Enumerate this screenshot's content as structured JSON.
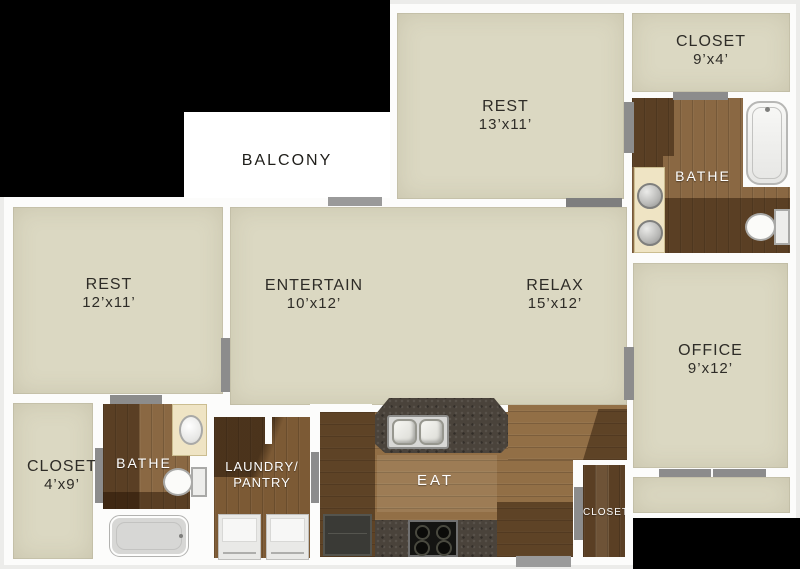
{
  "rooms": {
    "balcony": {
      "label": "BALCONY"
    },
    "rest_top": {
      "label": "REST",
      "dims": "13’x11’"
    },
    "closet_top_right": {
      "label": "CLOSET",
      "dims": "9’x4’"
    },
    "bathe_top": {
      "label": "BATHE"
    },
    "office": {
      "label": "OFFICE",
      "dims": "9’x12’"
    },
    "rest_left": {
      "label": "REST",
      "dims": "12’x11’"
    },
    "entertain": {
      "label": "ENTERTAIN",
      "dims": "10’x12’"
    },
    "relax": {
      "label": "RELAX",
      "dims": "15’x12’"
    },
    "closet_left": {
      "label": "CLOSET",
      "dims": "4’x9’"
    },
    "bathe_bottom": {
      "label": "BATHE"
    },
    "laundry": {
      "line1": "LAUNDRY/",
      "line2": "PANTRY"
    },
    "eat": {
      "label": "EAT"
    },
    "closet_bottom_right": {
      "label": "CLOSET"
    }
  },
  "colors": {
    "background-black": "#000000",
    "wall-white": "#fcfcfb",
    "room-beige": "#dbd8c2",
    "wood-medium": "#8a6843",
    "wood-eat": "#926f46",
    "wood-laundry": "#7c5a35",
    "wood-closet-dark": "#5a3f24",
    "granite-dark": "#4a433b",
    "door-gray": "#8c8c8c",
    "vanity-cream": "#efe4c4",
    "label-dark": "#2e2c27",
    "label-light": "#ffffff"
  }
}
